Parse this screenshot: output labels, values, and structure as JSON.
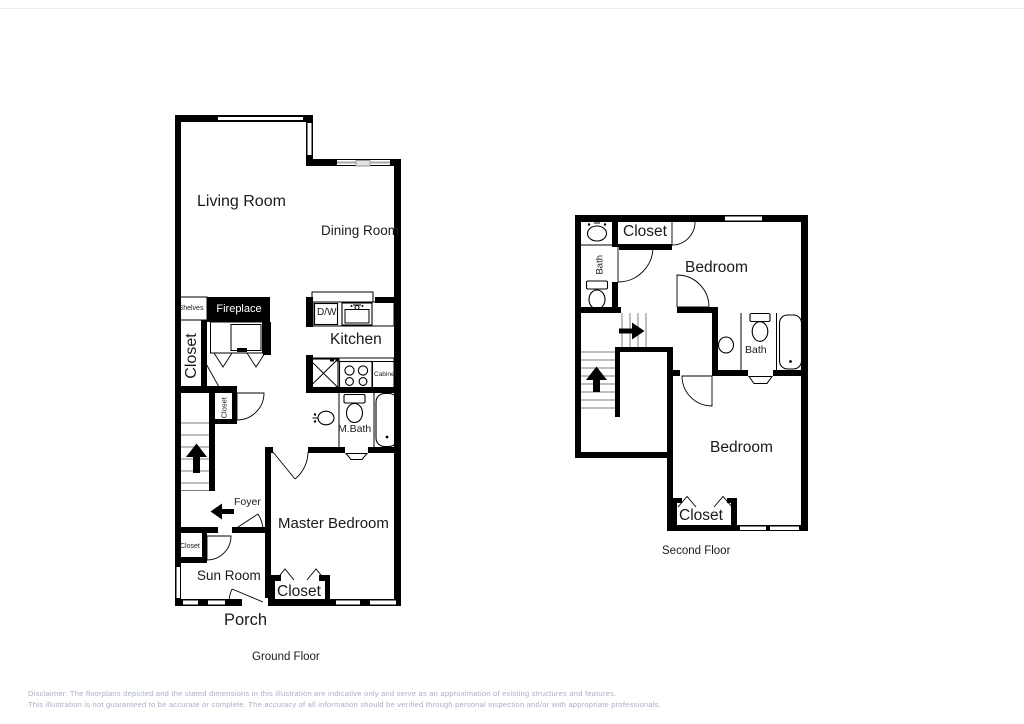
{
  "ground": {
    "floor_label": "Ground Floor",
    "living_room": "Living Room",
    "dining_room": "Dining Room",
    "kitchen": "Kitchen",
    "dw": "D/W",
    "cabinet": "Cabinet",
    "fireplace": "Fireplace",
    "shelves": "Shelves",
    "closet_main": "Closet",
    "closet_hall": "Closet",
    "closet_sunroom": "Closet",
    "closet_master": "Closet",
    "m_bath": "M.Bath",
    "master_bedroom": "Master Bedroom",
    "foyer": "Foyer",
    "sun_room": "Sun Room",
    "porch": "Porch"
  },
  "second": {
    "floor_label": "Second Floor",
    "closet_top": "Closet",
    "bedroom_top": "Bedroom",
    "bath_left": "Bath",
    "bath_right": "Bath",
    "bedroom_bottom": "Bedroom",
    "closet_bottom": "Closet"
  },
  "disclaimer": {
    "line1": "Disclaimer: The floorplans depicted and the stated dimensions in this illustration are indicative only and serve as an approximation of existing structures and features.",
    "line2": "This illustration is not guaranteed to be accurate or complete. The accuracy of all information should be verified through personal inspection and/or with appropriate professionals."
  },
  "colors": {
    "wall": "#000000",
    "window_gray": "#a8a8a8",
    "disclaimer_text": "#a9b0c4",
    "background": "#ffffff",
    "fireplace_fill": "#000000"
  }
}
